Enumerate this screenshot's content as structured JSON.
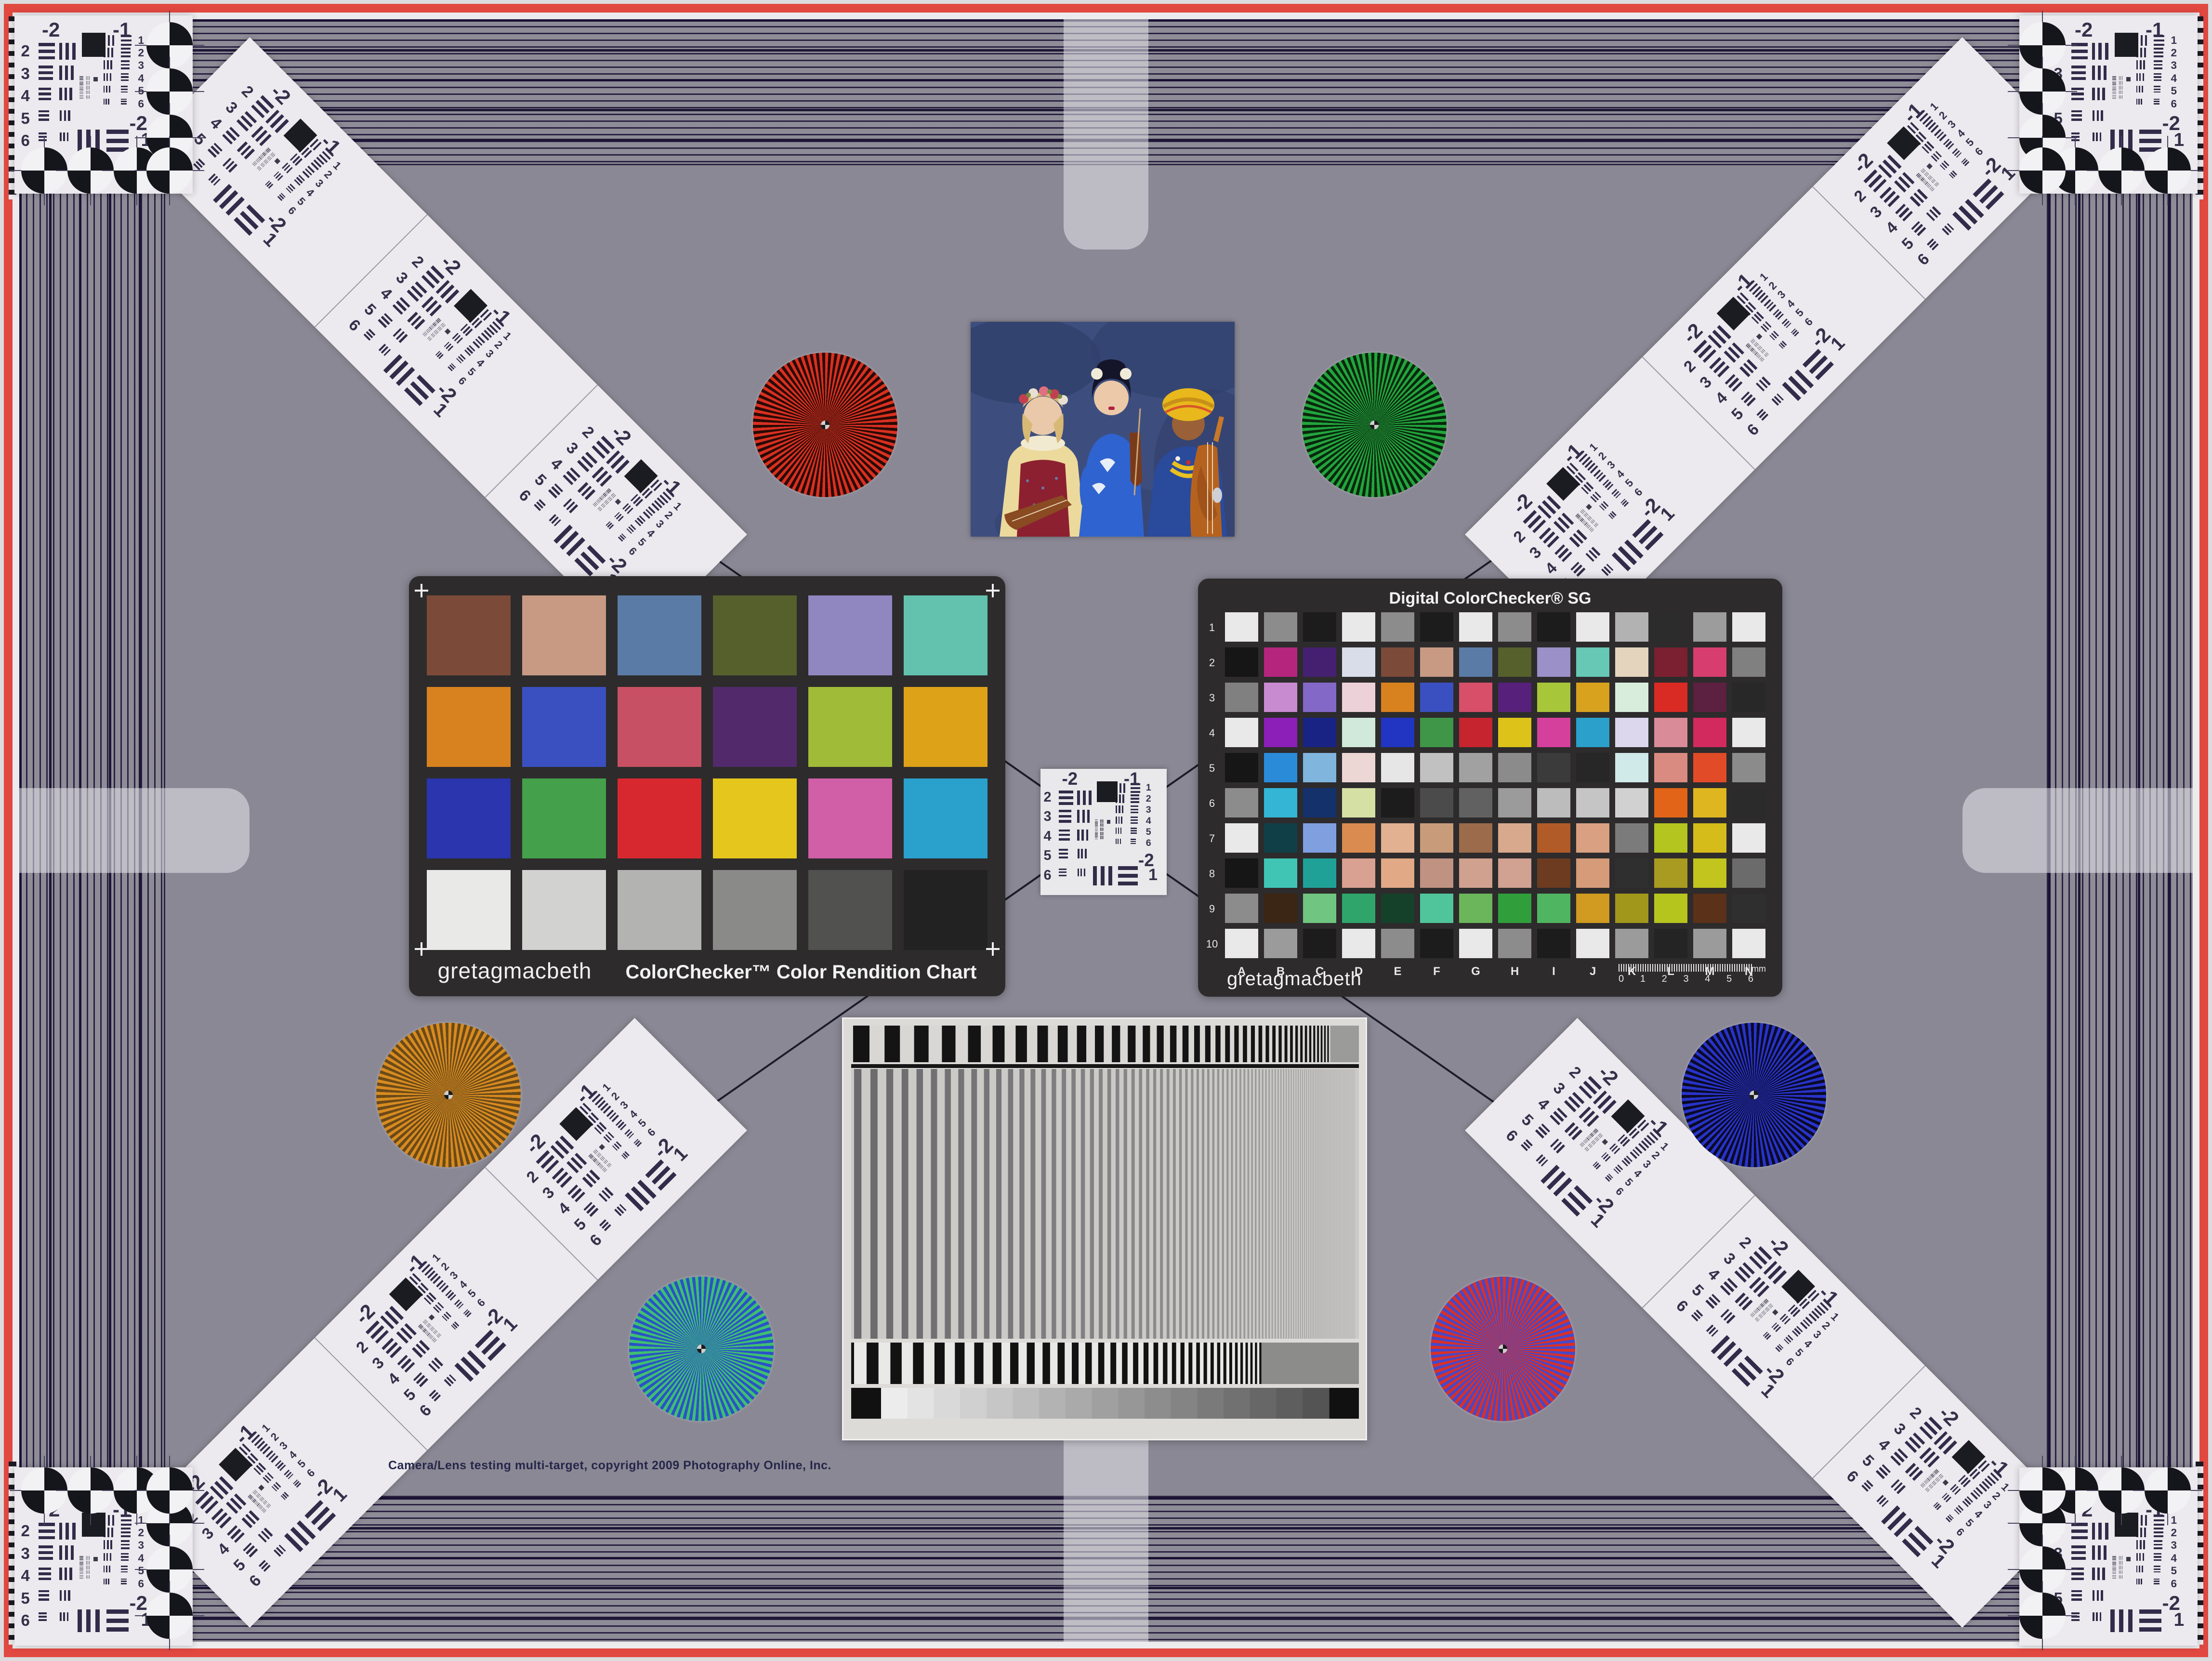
{
  "meta": {
    "copyright": "Camera/Lens testing multi-target, copyright 2009 Photography Online, Inc."
  },
  "colors": {
    "background": "#8a8894",
    "frame_red": "#e04840",
    "frame_pale": "#ecebee",
    "stripe_base": "#8e8c96",
    "stripe_line": "#1c1434",
    "card_white": "#eceaee",
    "chart_body": "#2d2b2c",
    "bar_ink": "#322c4a"
  },
  "usaf": {
    "top_left_label": "-2",
    "top_right_label": "-1",
    "left_numbers": [
      "2",
      "3",
      "4",
      "5",
      "6"
    ],
    "right_numbers": [
      "1",
      "2",
      "3",
      "4",
      "5",
      "6"
    ],
    "bottom_labels": [
      "-2",
      "1"
    ]
  },
  "classic_chart": {
    "brand": "gretagmacbeth",
    "title": "ColorChecker™ Color Rendition Chart",
    "rows": 4,
    "cols": 6,
    "patches": [
      "#7c4a39",
      "#c89a84",
      "#5a7ba6",
      "#55602c",
      "#9087c0",
      "#62c2ae",
      "#d8821f",
      "#3a50c1",
      "#c85064",
      "#522a6c",
      "#a0bb38",
      "#dda218",
      "#2a35ae",
      "#44a04a",
      "#d7282f",
      "#e4c61d",
      "#d05fa8",
      "#2aa0cd",
      "#e9e9e7",
      "#d2d2d0",
      "#b3b3b1",
      "#8a8a88",
      "#515150",
      "#222222"
    ]
  },
  "sg_chart": {
    "title": "Digital ColorChecker® SG",
    "brand": "gretagmacbeth",
    "row_labels": [
      "1",
      "2",
      "3",
      "4",
      "5",
      "6",
      "7",
      "8",
      "9",
      "10"
    ],
    "col_labels": [
      "A",
      "B",
      "C",
      "D",
      "E",
      "F",
      "G",
      "H",
      "I",
      "J",
      "K",
      "L",
      "M",
      "N"
    ],
    "ruler": {
      "ticks": [
        "0",
        "1",
        "2",
        "3",
        "4",
        "5",
        "6"
      ],
      "unit": "mm"
    },
    "patches": [
      [
        "#e9e9e9",
        "#8c8c8c",
        "#1c1c1c",
        "#e9e9e9",
        "#8c8c8c",
        "#1c1c1c",
        "#e9e9e9",
        "#8c8c8c",
        "#1c1c1c",
        "#e9e9e9",
        "#b2b2b2",
        "#2c2c2c",
        "#9c9c9c",
        "#e9e9e9"
      ],
      [
        "#161616",
        "#b5257e",
        "#452070",
        "#d8dde9",
        "#7c4a39",
        "#c89a84",
        "#5a7ba6",
        "#55602c",
        "#9b90c8",
        "#66c8b5",
        "#e4d4be",
        "#7a2030",
        "#d73d6e",
        "#808080"
      ],
      [
        "#808080",
        "#c98bd0",
        "#8468c8",
        "#edd1d9",
        "#d8821f",
        "#3a50c1",
        "#d84f69",
        "#57207a",
        "#a8c63a",
        "#d8a21f",
        "#d9eddd",
        "#da2a24",
        "#5c2040",
        "#282828"
      ],
      [
        "#e9e9e9",
        "#8b1fb8",
        "#182384",
        "#d0e9db",
        "#2135c2",
        "#3f9548",
        "#c6242e",
        "#ddc21a",
        "#d6409d",
        "#2ba0ca",
        "#ddd7ed",
        "#d98b97",
        "#d22a5e",
        "#e9e9e9"
      ],
      [
        "#161616",
        "#2a8bd9",
        "#80b5dd",
        "#edd7d5",
        "#e6e6e6",
        "#c1c1c1",
        "#a1a1a1",
        "#8b8b8b",
        "#3b3b3b",
        "#272727",
        "#d0e9e9",
        "#da8b81",
        "#e14b28",
        "#8b8b8b"
      ],
      [
        "#8c8c8c",
        "#35b5d5",
        "#14316c",
        "#d5e0a5",
        "#1c1c1c",
        "#4b4b4b",
        "#616161",
        "#9b9b9b",
        "#bcbcbc",
        "#c5c5c5",
        "#d1d1d1",
        "#e16418",
        "#deb61f",
        "#2b2b2b"
      ],
      [
        "#e9e9e9",
        "#103f47",
        "#809fdf",
        "#da8b50",
        "#e1b191",
        "#c89b7b",
        "#9b6b4b",
        "#d9a98d",
        "#b15b29",
        "#d9a181",
        "#7b7b7b",
        "#b3c51e",
        "#d5bc1b",
        "#e9e9e9"
      ],
      [
        "#161616",
        "#40c5b5",
        "#20a197",
        "#d9a191",
        "#e1a985",
        "#c09281",
        "#d0a18f",
        "#d1a191",
        "#6c3b20",
        "#d69b79",
        "#2f2f2f",
        "#a99b21",
        "#c1c51e",
        "#6b6b6b"
      ],
      [
        "#8c8c8c",
        "#3b2515",
        "#70c580",
        "#30a56b",
        "#15412b",
        "#50c59b",
        "#6bb55b",
        "#309f3b",
        "#50b560",
        "#d09b20",
        "#a1971b",
        "#b5c51e",
        "#5b3119",
        "#2f2f2f"
      ],
      [
        "#e9e9e9",
        "#9b9b9b",
        "#1c1c1c",
        "#e9e9e9",
        "#8c8c8c",
        "#1c1c1c",
        "#e9e9e9",
        "#8c8c8c",
        "#1c1c1c",
        "#e9e9e9",
        "#9b9b9b",
        "#242424",
        "#9b9b9b",
        "#e9e9e9"
      ]
    ]
  },
  "stars": [
    {
      "name": "red-star",
      "c1": "#d93020",
      "c2": "#2a0a06"
    },
    {
      "name": "green-star",
      "c1": "#23a53d",
      "c2": "#08280d"
    },
    {
      "name": "orange-star",
      "c1": "#d88b20",
      "c2": "#6b4a18"
    },
    {
      "name": "navy-star",
      "c1": "#2833c9",
      "c2": "#0a0a28"
    },
    {
      "name": "green-blue-star",
      "c1": "#3fbf70",
      "c2": "#2a52c8"
    },
    {
      "name": "red-blue-star",
      "c1": "#d83028",
      "c2": "#4848c8"
    }
  ]
}
